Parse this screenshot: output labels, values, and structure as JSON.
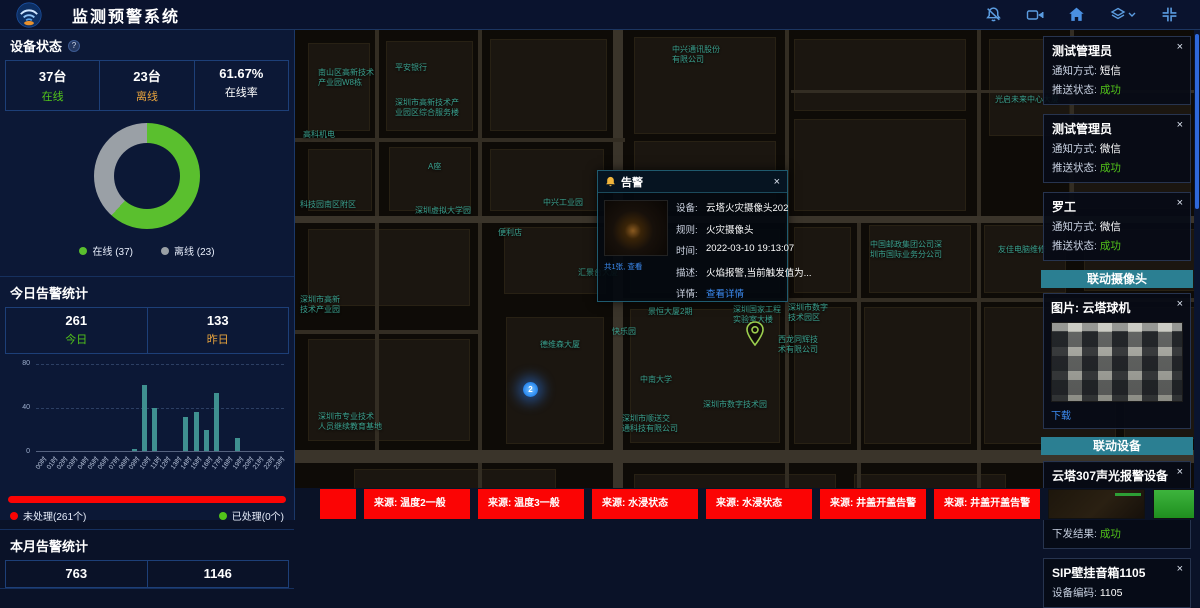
{
  "ui": {
    "close_glyph": "×",
    "help_glyph": "?"
  },
  "header": {
    "title": "监测预警系统",
    "icon_names": [
      "bell-muted-icon",
      "video-camera-icon",
      "home-icon",
      "layers-icon",
      "fullscreen-icon"
    ],
    "icon_color": "#5b9ce0"
  },
  "left_panel": {
    "device_status": {
      "title": "设备状态",
      "stats": [
        {
          "value": "37台",
          "label": "在线",
          "color": "#52c41a"
        },
        {
          "value": "23台",
          "label": "离线",
          "color": "#e8a33d"
        },
        {
          "value": "61.67%",
          "label": "在线率",
          "color": "#ffffff"
        }
      ],
      "chart_data": {
        "type": "pie",
        "donut": true,
        "categories": [
          "在线",
          "离线"
        ],
        "values": [
          37,
          23
        ],
        "colors": [
          "#5abf2e",
          "#9aa0a6"
        ]
      },
      "legend": [
        {
          "label": "在线 (37)",
          "color": "#5abf2e"
        },
        {
          "label": "离线 (23)",
          "color": "#9aa0a6"
        }
      ]
    },
    "today_alarms": {
      "title": "今日告警统计",
      "stats": [
        {
          "value": "261",
          "label": "今日",
          "color": "#52c41a"
        },
        {
          "value": "133",
          "label": "昨日",
          "color": "#e8a33d"
        }
      ],
      "chart_data": {
        "type": "bar",
        "categories": [
          "00时",
          "01时",
          "02时",
          "03时",
          "04时",
          "05时",
          "06时",
          "07时",
          "08时",
          "09时",
          "10时",
          "11时",
          "12时",
          "13时",
          "14时",
          "15时",
          "16时",
          "17时",
          "18时",
          "19时",
          "20时",
          "21时",
          "22时",
          "23时"
        ],
        "values": [
          0,
          0,
          0,
          0,
          0,
          0,
          0,
          0,
          0,
          2,
          61,
          40,
          0,
          0,
          31,
          36,
          19,
          53,
          0,
          12,
          0,
          0,
          0,
          0
        ],
        "ylim": [
          0,
          80
        ],
        "yticks": [
          0,
          40,
          80
        ],
        "bar_color": "#3f9090",
        "grid": true
      },
      "progress": {
        "unprocessed_label": "未处理(261个)",
        "processed_label": "已处理(0个)",
        "unprocessed_color": "#fb0404",
        "processed_color": "#52c41a",
        "unprocessed_pct": 100
      }
    },
    "month_alarms": {
      "title": "本月告警统计",
      "stats": [
        {
          "value": "763"
        },
        {
          "value": "1146"
        }
      ]
    }
  },
  "map": {
    "labels": [
      {
        "text": "中兴通讯股份\n有限公司",
        "x": 377,
        "y": 15
      },
      {
        "text": "平安银行",
        "x": 100,
        "y": 33
      },
      {
        "text": "南山区高新技术\n产业园W8栋",
        "x": 23,
        "y": 38
      },
      {
        "text": "深圳市高新技术产\n业园区综合服务楼",
        "x": 100,
        "y": 68
      },
      {
        "text": "高科机电",
        "x": 8,
        "y": 100
      },
      {
        "text": "A座",
        "x": 133,
        "y": 132
      },
      {
        "text": "中兴工业园",
        "x": 248,
        "y": 168
      },
      {
        "text": "深圳虚拟大学园",
        "x": 120,
        "y": 176
      },
      {
        "text": "科技园南区附区",
        "x": 5,
        "y": 170
      },
      {
        "text": "便利店",
        "x": 203,
        "y": 198
      },
      {
        "text": "汇景台大厦",
        "x": 283,
        "y": 238
      },
      {
        "text": "德维森大厦",
        "x": 245,
        "y": 310
      },
      {
        "text": "快乐园",
        "x": 317,
        "y": 297
      },
      {
        "text": "景恒大厦2期",
        "x": 353,
        "y": 277
      },
      {
        "text": "深圳国家工程\n实验室大楼",
        "x": 438,
        "y": 275
      },
      {
        "text": "深圳市数字\n技术园区",
        "x": 493,
        "y": 273
      },
      {
        "text": "西龙同辉技\n术有限公司",
        "x": 483,
        "y": 305
      },
      {
        "text": "中南大学",
        "x": 345,
        "y": 345
      },
      {
        "text": "深圳市数字技术园",
        "x": 408,
        "y": 370
      },
      {
        "text": "深圳市顺送交\n通科技有限公司",
        "x": 327,
        "y": 384
      },
      {
        "text": "深圳市专业技术\n人员继续教育基地",
        "x": 23,
        "y": 382
      },
      {
        "text": "深圳市高新\n技术产业园",
        "x": 5,
        "y": 265
      },
      {
        "text": "中国邮政集团公司深\n圳市国际业务分公司",
        "x": 575,
        "y": 210
      },
      {
        "text": "友佳电脑维修",
        "x": 703,
        "y": 215
      },
      {
        "text": "光启未来中心大厦",
        "x": 700,
        "y": 65
      }
    ],
    "markers": {
      "cluster": {
        "count": "2",
        "x": 228,
        "y": 352
      },
      "pin": {
        "x": 450,
        "y": 291,
        "color": "#9ccf4e"
      }
    },
    "popup": {
      "title": "告警",
      "image_caption": "共1张, 查看",
      "fields": [
        {
          "label": "设备:",
          "value": "云塔火灾摄像头202"
        },
        {
          "label": "规则:",
          "value": "火灾摄像头"
        },
        {
          "label": "时间:",
          "value": "2022-03-10 19:13:07"
        },
        {
          "label": "描述:",
          "value": "火焰报警,当前触发值为..."
        },
        {
          "label": "详情:",
          "value": "查看详情"
        }
      ]
    }
  },
  "right_panel": {
    "notifications": [
      {
        "name": "测试管理员",
        "method_label": "通知方式:",
        "method": "短信",
        "status_label": "推送状态:",
        "status": "成功"
      },
      {
        "name": "测试管理员",
        "method_label": "通知方式:",
        "method": "微信",
        "status_label": "推送状态:",
        "status": "成功"
      },
      {
        "name": "罗工",
        "method_label": "通知方式:",
        "method": "微信",
        "status_label": "推送状态:",
        "status": "成功"
      }
    ],
    "camera_banner": "联动摄像头",
    "camera_card": {
      "image_label": "图片: 云塔球机",
      "download_label": "下载"
    },
    "device_banner": "联动设备",
    "device_cards": [
      {
        "name": "云塔307声光报警设备",
        "rows": [
          {
            "label": "设备编码:",
            "value": "ffffff100001ab6c"
          },
          {
            "label": "调用服务:",
            "value": "报警"
          },
          {
            "label": "下发结果:",
            "value": "成功"
          }
        ]
      },
      {
        "name": "SIP壁挂音箱1105",
        "rows": [
          {
            "label": "设备编码:",
            "value": "1105"
          }
        ]
      }
    ]
  },
  "bottom_bar": {
    "alerts": [
      {
        "label": ""
      },
      {
        "label": "来源: 温度2一般"
      },
      {
        "label": "来源: 温度3一般"
      },
      {
        "label": "来源: 水浸状态"
      },
      {
        "label": "来源: 水浸状态"
      },
      {
        "label": "来源: 井盖开盖告警"
      },
      {
        "label": "来源: 井盖开盖告警"
      }
    ],
    "thumbnail_names": [
      "alert-image-dark",
      "alert-image-green"
    ],
    "alert_color": "#fb0404"
  }
}
